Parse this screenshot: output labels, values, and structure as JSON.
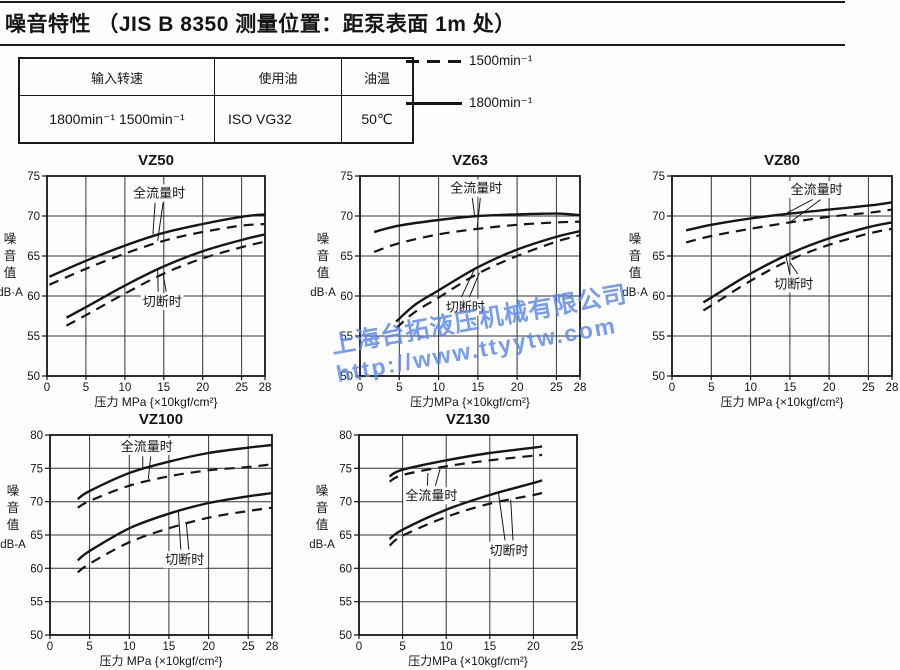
{
  "header": {
    "title": "噪音特性 （JIS B 8350 测量位置：距泵表面 1m 处）"
  },
  "conditions_table": {
    "headers": [
      "输入转速",
      "使用油",
      "油温"
    ],
    "row": [
      "1800min⁻¹  1500min⁻¹",
      "ISO VG32",
      "50℃"
    ]
  },
  "legend": {
    "items": [
      {
        "label": "1500min⁻¹",
        "style": "dashed"
      },
      {
        "label": "1800min⁻¹",
        "style": "solid"
      }
    ]
  },
  "watermark": {
    "line1": "上海台拓液压机械有限公司",
    "line2": "http://www.ttyytw.com",
    "color": "#5787f0"
  },
  "chart_data": [
    {
      "type": "line",
      "title": "VZ50",
      "ylabel": "噪音值",
      "ylabel_unit": "dB·A",
      "xlabel": "压力 MPa {×10kgf/cm²}",
      "xlim": [
        0,
        28
      ],
      "ylim": [
        50,
        75
      ],
      "xticks": [
        0,
        5,
        10,
        15,
        20,
        25,
        28
      ],
      "yticks": [
        50,
        55,
        60,
        65,
        70,
        75
      ],
      "grid": true,
      "series": [
        {
          "name": "全流量时 1800min⁻¹",
          "line": "solid",
          "x": [
            0.3,
            5,
            10,
            15,
            20,
            25,
            28
          ],
          "y": [
            62.4,
            64.4,
            66.3,
            67.9,
            69.0,
            69.9,
            70.2
          ]
        },
        {
          "name": "全流量时 1500min⁻¹",
          "line": "dashed",
          "x": [
            0.3,
            5,
            10,
            15,
            20,
            25,
            28
          ],
          "y": [
            61.4,
            63.4,
            65.3,
            66.9,
            68.0,
            68.8,
            69.0
          ]
        },
        {
          "name": "切断时 1800min⁻¹",
          "line": "solid",
          "x": [
            2.5,
            5,
            10,
            15,
            20,
            25,
            28
          ],
          "y": [
            57.3,
            58.6,
            61.3,
            63.7,
            65.6,
            67.0,
            67.7
          ]
        },
        {
          "name": "切断时 1500min⁻¹",
          "line": "dashed",
          "x": [
            2.5,
            5,
            10,
            15,
            20,
            25,
            28
          ],
          "y": [
            56.3,
            57.6,
            60.3,
            62.8,
            64.7,
            66.1,
            66.8
          ]
        }
      ],
      "annotations": [
        {
          "text": "全流量时",
          "at": [
            14.4,
            72.9
          ],
          "targets": [
            [
              13.6,
              67.7
            ],
            [
              14.2,
              66.9
            ]
          ]
        },
        {
          "text": "切断时",
          "at": [
            14.8,
            59.3
          ],
          "targets": [
            [
              14.2,
              63.4
            ],
            [
              14.9,
              62.8
            ]
          ]
        }
      ]
    },
    {
      "type": "line",
      "title": "VZ63",
      "ylabel": "噪音值",
      "ylabel_unit": "dB·A",
      "xlabel": "压力MPa {×10kgf/cm²}",
      "xlim": [
        0,
        28
      ],
      "ylim": [
        50,
        75
      ],
      "xticks": [
        0,
        5,
        10,
        15,
        20,
        25,
        28
      ],
      "yticks": [
        50,
        55,
        60,
        65,
        70,
        75
      ],
      "grid": true,
      "series": [
        {
          "name": "全流量时 1800min⁻¹",
          "line": "solid",
          "x": [
            1.8,
            5,
            10,
            15,
            20,
            25,
            28
          ],
          "y": [
            68.0,
            68.8,
            69.5,
            70.0,
            70.2,
            70.3,
            70.1
          ]
        },
        {
          "name": "全流量时 1500min⁻¹",
          "line": "dashed",
          "x": [
            1.8,
            5,
            10,
            15,
            20,
            25,
            28
          ],
          "y": [
            65.5,
            66.6,
            67.7,
            68.4,
            68.9,
            69.2,
            69.3
          ]
        },
        {
          "name": "切断时 1800min⁻¹",
          "line": "solid",
          "x": [
            4.6,
            7,
            10,
            15,
            20,
            25,
            28
          ],
          "y": [
            56.8,
            58.9,
            60.7,
            63.6,
            65.8,
            67.4,
            68.1
          ]
        },
        {
          "name": "切断时 1500min⁻¹",
          "line": "dashed",
          "x": [
            4.6,
            7,
            10,
            15,
            20,
            25,
            28
          ],
          "y": [
            56.0,
            58.0,
            59.8,
            62.8,
            65.0,
            66.8,
            67.6
          ]
        }
      ],
      "annotations": [
        {
          "text": "全流量时",
          "at": [
            14.8,
            73.5
          ],
          "targets": [
            [
              14.6,
              70.0
            ],
            [
              14.9,
              68.4
            ]
          ]
        },
        {
          "text": "切断时",
          "at": [
            13.4,
            58.6
          ],
          "targets": [
            [
              14.6,
              63.4
            ],
            [
              15.2,
              62.9
            ]
          ]
        }
      ]
    },
    {
      "type": "line",
      "title": "VZ80",
      "ylabel": "噪音值",
      "ylabel_unit": "dB·A",
      "xlabel": "压力 MPa {×10kgf/cm²}",
      "xlim": [
        0,
        28
      ],
      "ylim": [
        50,
        75
      ],
      "xticks": [
        0,
        5,
        10,
        15,
        20,
        25,
        28
      ],
      "yticks": [
        50,
        55,
        60,
        65,
        70,
        75
      ],
      "grid": true,
      "series": [
        {
          "name": "全流量时 1800min⁻¹",
          "line": "solid",
          "x": [
            1.8,
            5,
            10,
            15,
            20,
            25,
            28
          ],
          "y": [
            68.2,
            68.9,
            69.7,
            70.3,
            70.8,
            71.3,
            71.7
          ]
        },
        {
          "name": "全流量时 1500min⁻¹",
          "line": "dashed",
          "x": [
            1.8,
            5,
            10,
            15,
            20,
            25,
            28
          ],
          "y": [
            66.7,
            67.5,
            68.4,
            69.2,
            69.9,
            70.4,
            70.8
          ]
        },
        {
          "name": "切断时 1800min⁻¹",
          "line": "solid",
          "x": [
            4,
            5,
            10,
            15,
            20,
            25,
            28
          ],
          "y": [
            59.2,
            59.8,
            62.8,
            65.3,
            67.2,
            68.6,
            69.2
          ]
        },
        {
          "name": "切断时 1500min⁻¹",
          "line": "dashed",
          "x": [
            4,
            5,
            10,
            15,
            20,
            25,
            28
          ],
          "y": [
            58.2,
            58.8,
            61.9,
            64.5,
            66.4,
            67.8,
            68.4
          ]
        }
      ],
      "annotations": [
        {
          "text": "全流量时",
          "at": [
            18.4,
            73.3
          ],
          "targets": [
            [
              14.3,
              70.2
            ],
            [
              15.0,
              69.2
            ]
          ]
        },
        {
          "text": "切断时",
          "at": [
            15.5,
            61.5
          ],
          "targets": [
            [
              14.5,
              65.0
            ],
            [
              15.0,
              64.2
            ]
          ]
        }
      ]
    },
    {
      "type": "line",
      "title": "VZ100",
      "ylabel": "噪音值",
      "ylabel_unit": "dB-A",
      "xlabel": "压力 MPa {×10kgf/cm²}",
      "xlim": [
        0,
        28
      ],
      "ylim": [
        50,
        80
      ],
      "xticks": [
        0,
        5,
        10,
        15,
        20,
        25,
        28
      ],
      "yticks": [
        50,
        55,
        60,
        65,
        70,
        75,
        80
      ],
      "grid": true,
      "series": [
        {
          "name": "全流量时 1800min⁻¹",
          "line": "solid",
          "x": [
            3.5,
            5,
            10,
            15,
            20,
            25,
            28
          ],
          "y": [
            70.4,
            71.6,
            74.3,
            76.0,
            77.3,
            78.1,
            78.5
          ]
        },
        {
          "name": "全流量时 1500min⁻¹",
          "line": "dashed",
          "x": [
            3.5,
            5,
            10,
            15,
            20,
            25,
            28
          ],
          "y": [
            69.1,
            70.1,
            72.4,
            73.8,
            74.7,
            75.2,
            75.6
          ]
        },
        {
          "name": "切断时 1800min⁻¹",
          "line": "solid",
          "x": [
            3.5,
            5,
            10,
            15,
            20,
            25,
            28
          ],
          "y": [
            61.2,
            62.6,
            66.0,
            68.2,
            69.8,
            70.8,
            71.3
          ]
        },
        {
          "name": "切断时 1500min⁻¹",
          "line": "dashed",
          "x": [
            3.5,
            5,
            10,
            15,
            20,
            25,
            28
          ],
          "y": [
            59.4,
            60.7,
            63.9,
            66.0,
            67.6,
            68.6,
            69.1
          ]
        }
      ],
      "annotations": [
        {
          "text": "全流量时",
          "at": [
            12.2,
            78.3
          ],
          "targets": [
            [
              11.7,
              75.0
            ],
            [
              12.4,
              73.4
            ]
          ]
        },
        {
          "text": "切断时",
          "at": [
            17.0,
            61.3
          ],
          "targets": [
            [
              16.2,
              68.5
            ],
            [
              17.2,
              66.6
            ]
          ]
        }
      ]
    },
    {
      "type": "line",
      "title": "VZ130",
      "ylabel": "噪音值",
      "ylabel_unit": "dB-A",
      "xlabel": "压力MPa {×10kgf/cm²}",
      "xlim": [
        0,
        25
      ],
      "ylim": [
        50,
        80
      ],
      "xticks": [
        0,
        5,
        10,
        15,
        20,
        25
      ],
      "yticks": [
        50,
        55,
        60,
        65,
        70,
        75,
        80
      ],
      "grid": true,
      "series": [
        {
          "name": "全流量时 1800min⁻¹",
          "line": "solid",
          "x": [
            3.5,
            5,
            10,
            15,
            20,
            21
          ],
          "y": [
            73.8,
            74.8,
            76.2,
            77.3,
            78.1,
            78.3
          ]
        },
        {
          "name": "全流量时 1500min⁻¹",
          "line": "dashed",
          "x": [
            3.5,
            5,
            10,
            15,
            20,
            21
          ],
          "y": [
            73.0,
            74.0,
            75.3,
            76.2,
            76.9,
            77.0
          ]
        },
        {
          "name": "切断时 1800min⁻¹",
          "line": "solid",
          "x": [
            3.5,
            5,
            10,
            15,
            20,
            21
          ],
          "y": [
            64.4,
            65.8,
            68.8,
            71.0,
            72.8,
            73.2
          ]
        },
        {
          "name": "切断时 1500min⁻¹",
          "line": "dashed",
          "x": [
            3.5,
            5,
            10,
            15,
            20,
            21
          ],
          "y": [
            63.4,
            64.9,
            67.7,
            69.7,
            71.0,
            71.3
          ]
        }
      ],
      "annotations": [
        {
          "text": "全流量时",
          "at": [
            8.3,
            70.9
          ],
          "targets": [
            [
              7.9,
              74.3
            ],
            [
              9.3,
              74.9
            ]
          ]
        },
        {
          "text": "切断时",
          "at": [
            17.2,
            62.7
          ],
          "targets": [
            [
              16.0,
              71.3
            ],
            [
              17.4,
              70.3
            ]
          ]
        }
      ]
    }
  ]
}
